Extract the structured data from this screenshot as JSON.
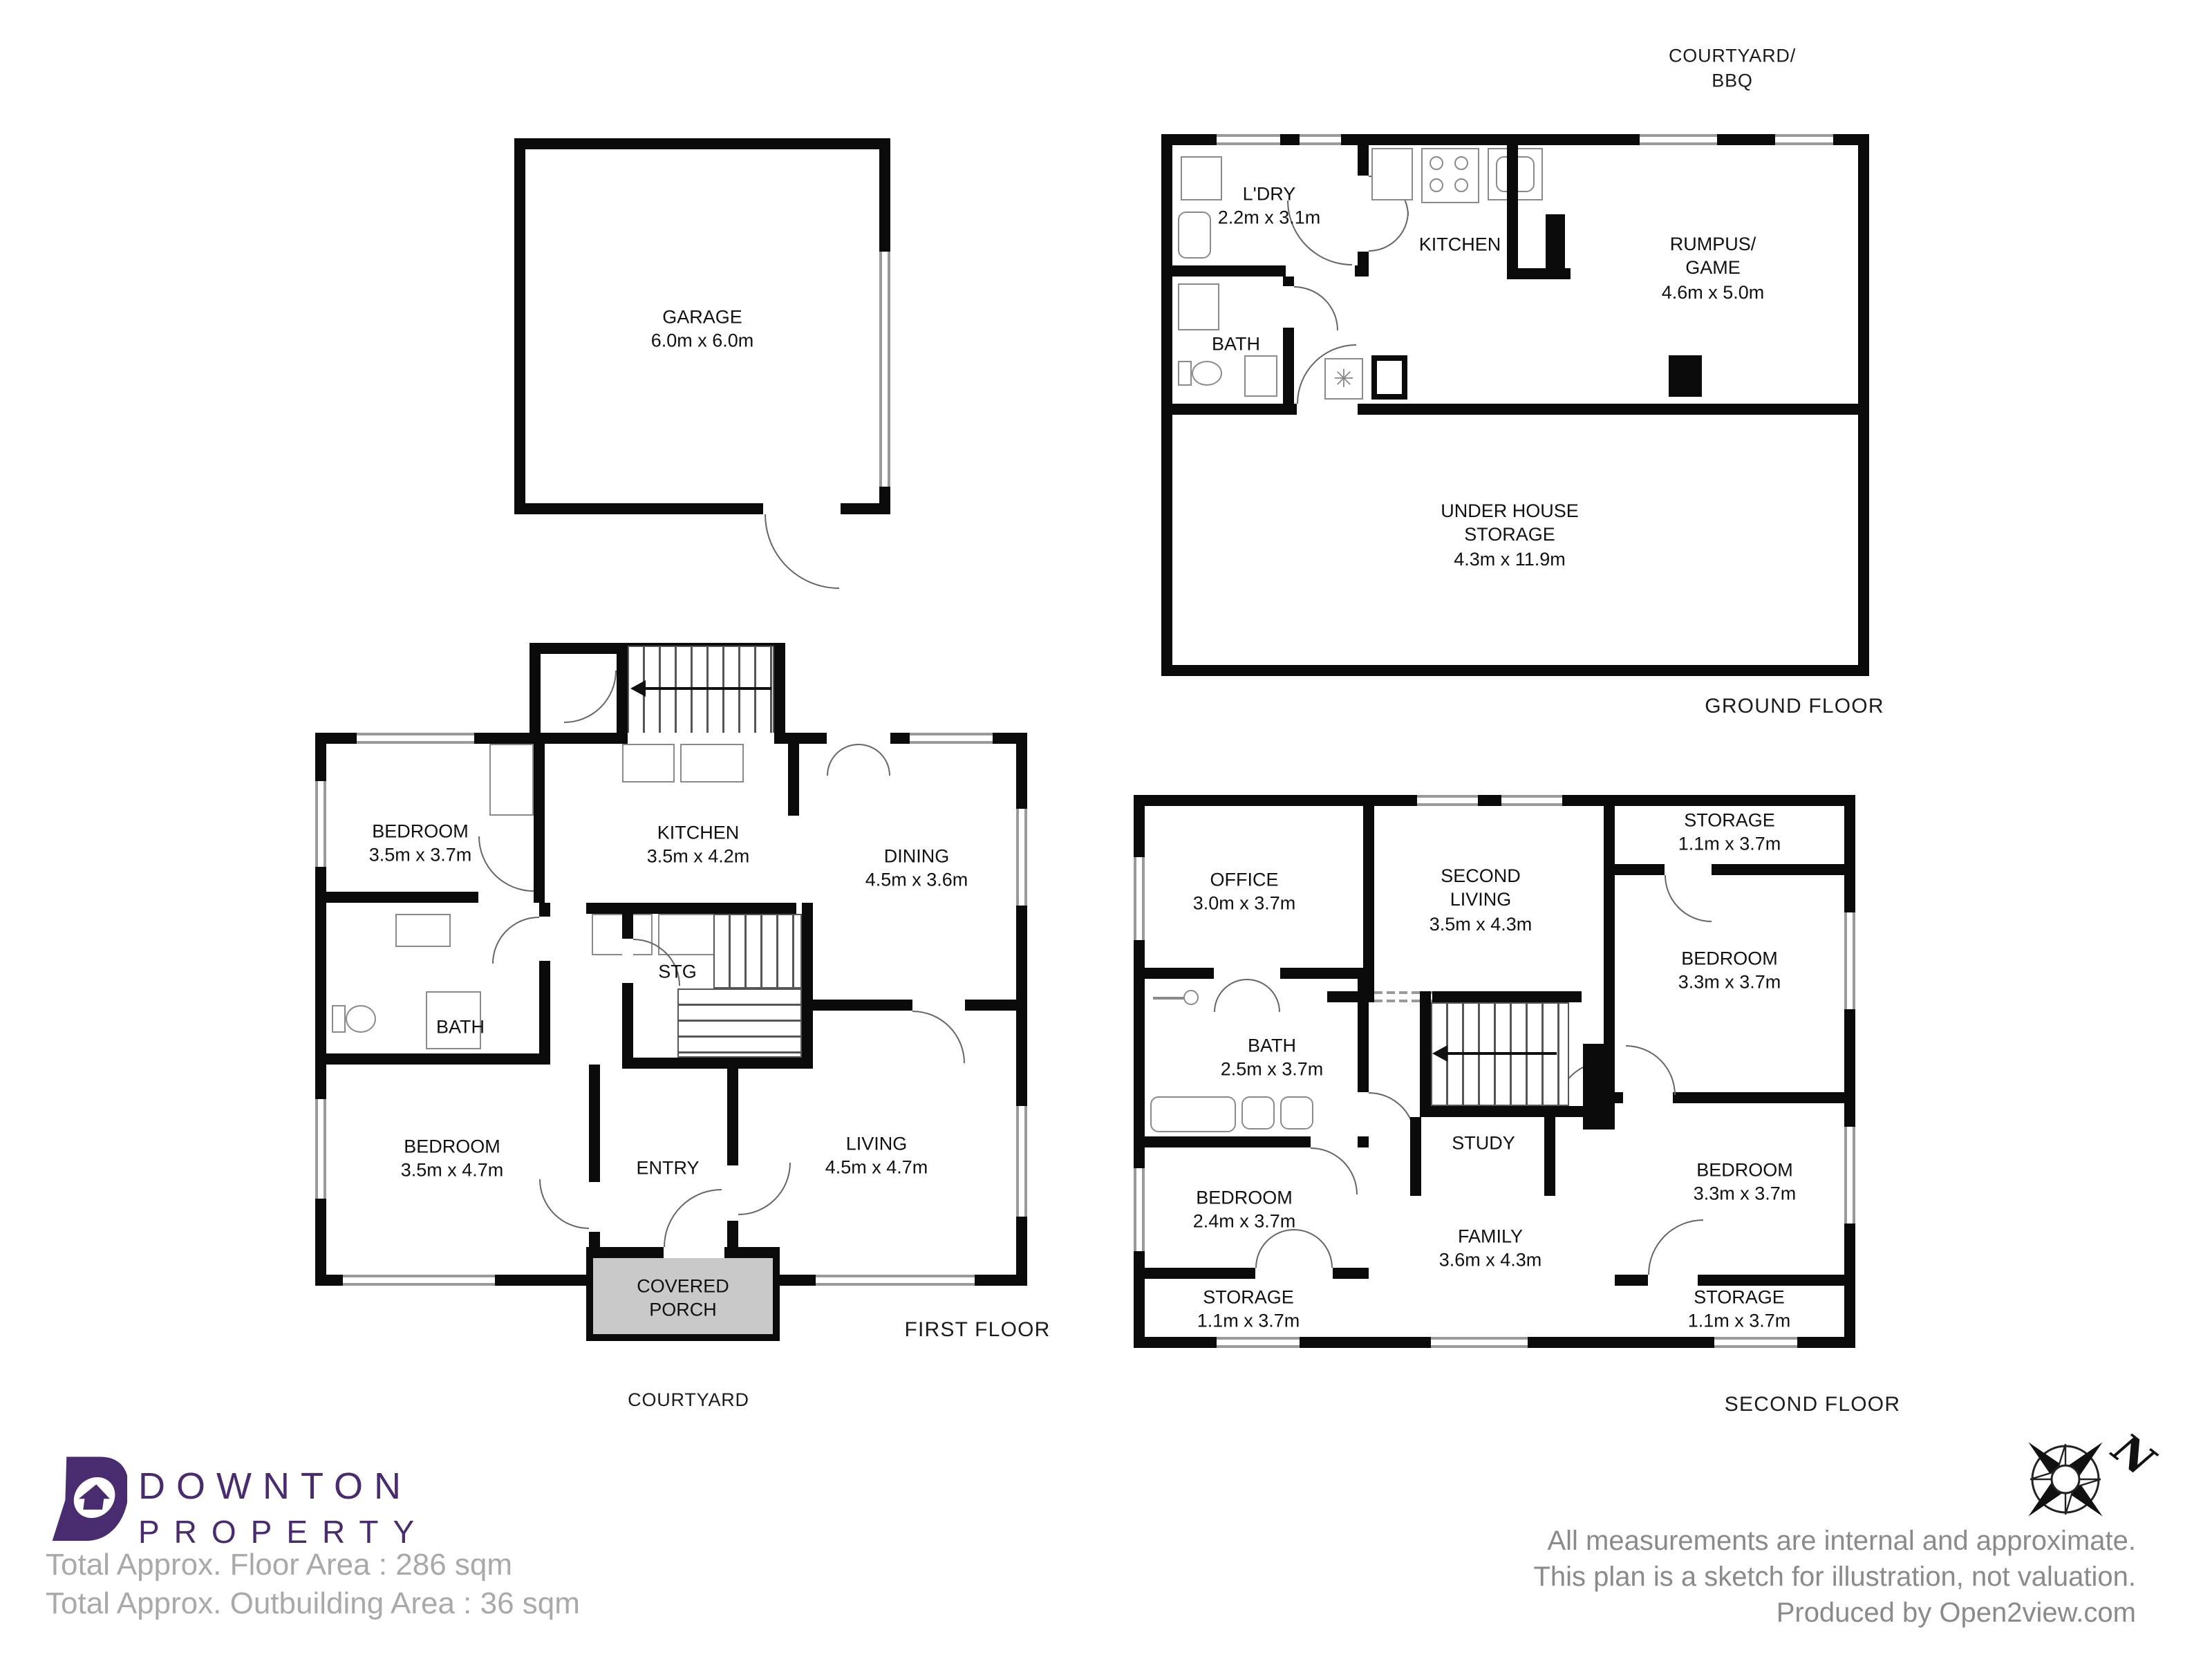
{
  "colors": {
    "wall": "#0a0a0a",
    "porch_fill": "#c9c9c9",
    "brand_purple": "#492c6f",
    "totals_text": "#a9a9a9",
    "note_text": "#8a8a8a"
  },
  "garage": {
    "name": "GARAGE",
    "dims": "6.0m x 6.0m"
  },
  "ground_floor": {
    "floor_label": "GROUND FLOOR",
    "outside_label_line1": "COURTYARD/",
    "outside_label_line2": "BBQ",
    "laundry": {
      "name": "L'DRY",
      "dims": "2.2m x 3.1m"
    },
    "kitchen": {
      "name": "KITCHEN"
    },
    "rumpus": {
      "line1": "RUMPUS/",
      "line2": "GAME",
      "dims": "4.6m x 5.0m"
    },
    "bath": {
      "name": "BATH"
    },
    "under_house": {
      "line1": "UNDER HOUSE",
      "line2": "STORAGE",
      "dims": "4.3m x 11.9m"
    }
  },
  "first_floor": {
    "floor_label": "FIRST FLOOR",
    "outside_label": "COURTYARD",
    "bedroom1": {
      "name": "BEDROOM",
      "dims": "3.5m x 3.7m"
    },
    "kitchen": {
      "name": "KITCHEN",
      "dims": "3.5m x 4.2m"
    },
    "dining": {
      "name": "DINING",
      "dims": "4.5m x 3.6m"
    },
    "stg": {
      "name": "STG"
    },
    "bath": {
      "name": "BATH"
    },
    "bedroom2": {
      "name": "BEDROOM",
      "dims": "3.5m x 4.7m"
    },
    "entry": {
      "name": "ENTRY"
    },
    "living": {
      "name": "LIVING",
      "dims": "4.5m x 4.7m"
    },
    "porch": {
      "line1": "COVERED",
      "line2": "PORCH"
    }
  },
  "second_floor": {
    "floor_label": "SECOND FLOOR",
    "office": {
      "name": "OFFICE",
      "dims": "3.0m x 3.7m"
    },
    "second_living": {
      "line1": "SECOND",
      "line2": "LIVING",
      "dims": "3.5m x 4.3m"
    },
    "storage_tr": {
      "name": "STORAGE",
      "dims": "1.1m x 3.7m"
    },
    "bedroom_tr": {
      "name": "BEDROOM",
      "dims": "3.3m x 3.7m"
    },
    "bath": {
      "name": "BATH",
      "dims": "2.5m x 3.7m"
    },
    "study": {
      "name": "STUDY"
    },
    "bedroom_l": {
      "name": "BEDROOM",
      "dims": "2.4m x 3.7m"
    },
    "family": {
      "name": "FAMILY",
      "dims": "3.6m x 4.3m"
    },
    "bedroom_br": {
      "name": "BEDROOM",
      "dims": "3.3m x 3.7m"
    },
    "storage_bl": {
      "name": "STORAGE",
      "dims": "1.1m x 3.7m"
    },
    "storage_br": {
      "name": "STORAGE",
      "dims": "1.1m x 3.7m"
    }
  },
  "branding": {
    "logo_line1": "DOWNTON",
    "logo_line2": "PROPERTY"
  },
  "footer": {
    "total_floor_area": "Total Approx. Floor Area : 286 sqm",
    "total_outbuilding_area": "Total Approx. Outbuilding Area : 36 sqm",
    "note_line1": "All measurements are internal and approximate.",
    "note_line2": "This plan is a sketch for illustration, not valuation.",
    "note_line3": "Produced by Open2view.com",
    "compass_n": "N"
  }
}
